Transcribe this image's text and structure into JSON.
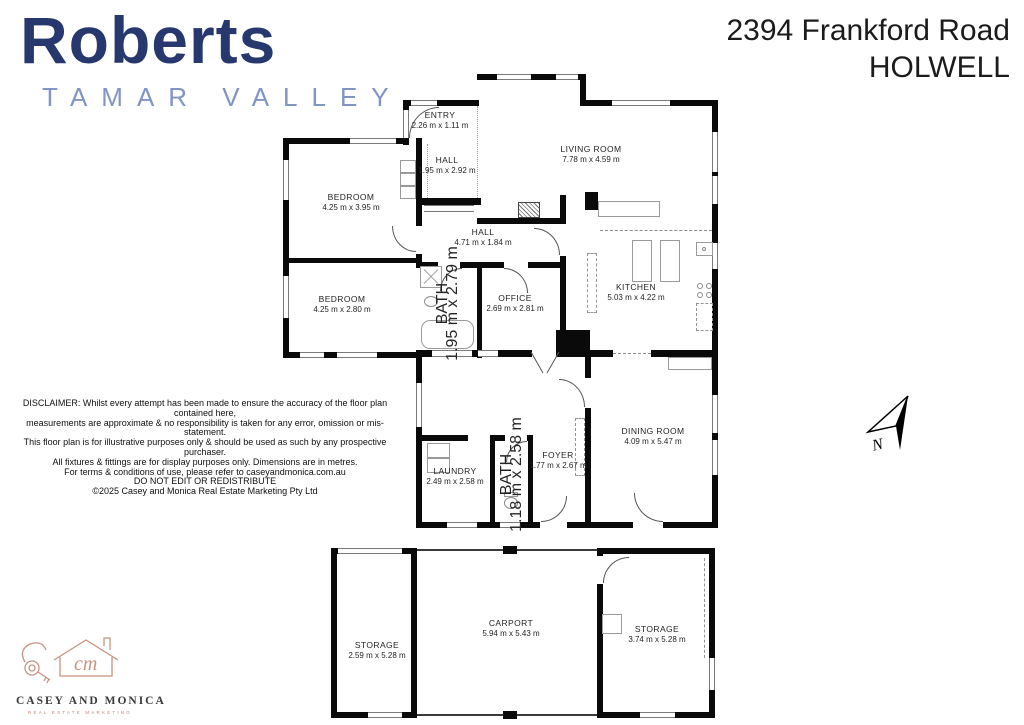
{
  "brand": {
    "name": "Roberts",
    "sub": "TAMAR VALLEY"
  },
  "address": {
    "line1": "2394 Frankford Road",
    "line2": "HOLWELL"
  },
  "rooms": [
    {
      "name": "ENTRY",
      "dims": "2.26 m x 1.11 m"
    },
    {
      "name": "HALL",
      "dims": "1.95 m x 2.92 m"
    },
    {
      "name": "LIVING ROOM",
      "dims": "7.78 m x 4.59 m"
    },
    {
      "name": "BEDROOM",
      "dims": "4.25 m x 3.95 m"
    },
    {
      "name": "HALL",
      "dims": "4.71 m x 1.84 m"
    },
    {
      "name": "BEDROOM",
      "dims": "4.25 m x 2.80 m"
    },
    {
      "name": "BATH",
      "dims": "1.95 m x 2.79 m"
    },
    {
      "name": "OFFICE",
      "dims": "2.69 m x 2.81 m"
    },
    {
      "name": "KITCHEN",
      "dims": "5.03 m x 4.22 m"
    },
    {
      "name": "LAUNDRY",
      "dims": "2.49 m x 2.58 m"
    },
    {
      "name": "BATH",
      "dims": "1.18 m x 2.58 m"
    },
    {
      "name": "FOYER",
      "dims": "1.77 m x 2.67 m"
    },
    {
      "name": "DINING ROOM",
      "dims": "4.09 m x 5.47 m"
    },
    {
      "name": "STORAGE",
      "dims": "2.59 m x 5.28 m"
    },
    {
      "name": "CARPORT",
      "dims": "5.94 m x 5.43 m"
    },
    {
      "name": "STORAGE",
      "dims": "3.74 m x 5.28 m"
    }
  ],
  "disclaimer": {
    "l1": "DISCLAIMER: Whilst every attempt has been made to ensure the accuracy of the floor plan contained here,",
    "l2": "measurements are approximate & no responsibility is taken for any error, omission or mis-statement.",
    "l3": "This floor plan is for illustrative purposes only & should be used as such by any prospective purchaser.",
    "l4": "All fixtures & fittings are for display purposes only. Dimensions are in metres.",
    "l5": "For terms & conditions of use, please refer to caseyandmonica.com.au",
    "l6": "DO NOT EDIT OR REDISTRIBUTE",
    "l7": "©2025 Casey and Monica Real Estate Marketing Pty Ltd"
  },
  "footer_logo": {
    "name": "CASEY AND MONICA",
    "tagline": "REAL ESTATE MARKETING"
  },
  "compass": {
    "label": "N"
  },
  "colors": {
    "brand_navy": "#27386e",
    "brand_blue": "#8094c5",
    "wall": "#0a0a0a",
    "logo_copper": "#c08a78"
  }
}
